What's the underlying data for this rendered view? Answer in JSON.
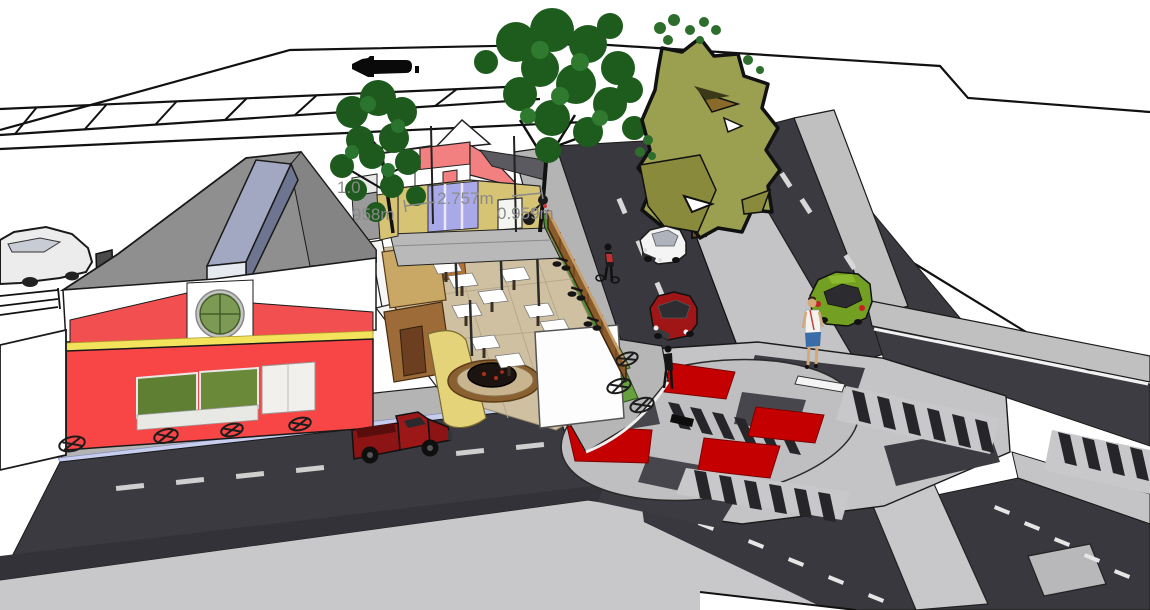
{
  "scene": {
    "type": "3d-model-render",
    "description": "Aerial three-quarter perspective render of an urban corner: red market hall and yellow courtyard restaurant beside a boulevard intersection with a red-and-white circular raised crossing",
    "background": "#ffffff"
  },
  "dimensions": {
    "color": "#8a8a8a",
    "labels": [
      {
        "id": "dim-1",
        "text": "1.0"
      },
      {
        "id": "dim-2",
        "text": "958m"
      },
      {
        "id": "dim-3",
        "text": "2.757m"
      },
      {
        "id": "dim-4",
        "text": "0.959m"
      }
    ]
  },
  "objects": {
    "red_building": {
      "name": "red market hall",
      "facade": "#f84545",
      "roof": "#8f8f8f",
      "ridge_monitor": "#a2a8c2",
      "accent_stripe": "#f2e25c",
      "window_green": "#6a8a3a",
      "round_window": "#7d9a55"
    },
    "yellow_building": {
      "name": "courtyard restaurant",
      "facade": "#d6c474",
      "gable": "#f28080",
      "doors": "#a9a9ea",
      "white_door": "#f4f4f0"
    },
    "courtyard": {
      "floor": "#cfc0a2",
      "tables": 11,
      "features": [
        "fire pit",
        "white screen",
        "timber walls",
        "slat fence",
        "parked bicycles"
      ]
    },
    "vehicles": [
      {
        "name": "red pickup truck",
        "color": "#8c1414"
      },
      {
        "name": "white car",
        "color": "#f4f4f4"
      },
      {
        "name": "red car",
        "color": "#a01616"
      },
      {
        "name": "green car",
        "color": "#73a022"
      },
      {
        "name": "gray car",
        "color": "#ececec"
      },
      {
        "name": "motorcycle",
        "color": "#222222"
      }
    ],
    "people": [
      {
        "name": "cyclist with red backpack"
      },
      {
        "name": "pedestrian at corner"
      },
      {
        "name": "woman walking on median"
      }
    ],
    "trees": [
      {
        "name": "street tree left",
        "foliage": "#1e5a1e"
      },
      {
        "name": "street tree right",
        "foliage": "#1d5c1d"
      },
      {
        "name": "median tree",
        "foliage": "#9aa050",
        "trunk": "#7a5126"
      }
    ],
    "intersection": {
      "style": "raised circular crossing",
      "circle_red": "#c40000",
      "plaza": "#c4c4c6",
      "zebra_dark": "#26262a"
    },
    "streets": {
      "asphalt": "#3a3a40",
      "sidewalk": "#b4b4b4",
      "curb_strip": "#c6cdee",
      "median": "#c4c4c6",
      "lane_dash": "#cfcfcf",
      "grass": "#66a13e"
    }
  }
}
